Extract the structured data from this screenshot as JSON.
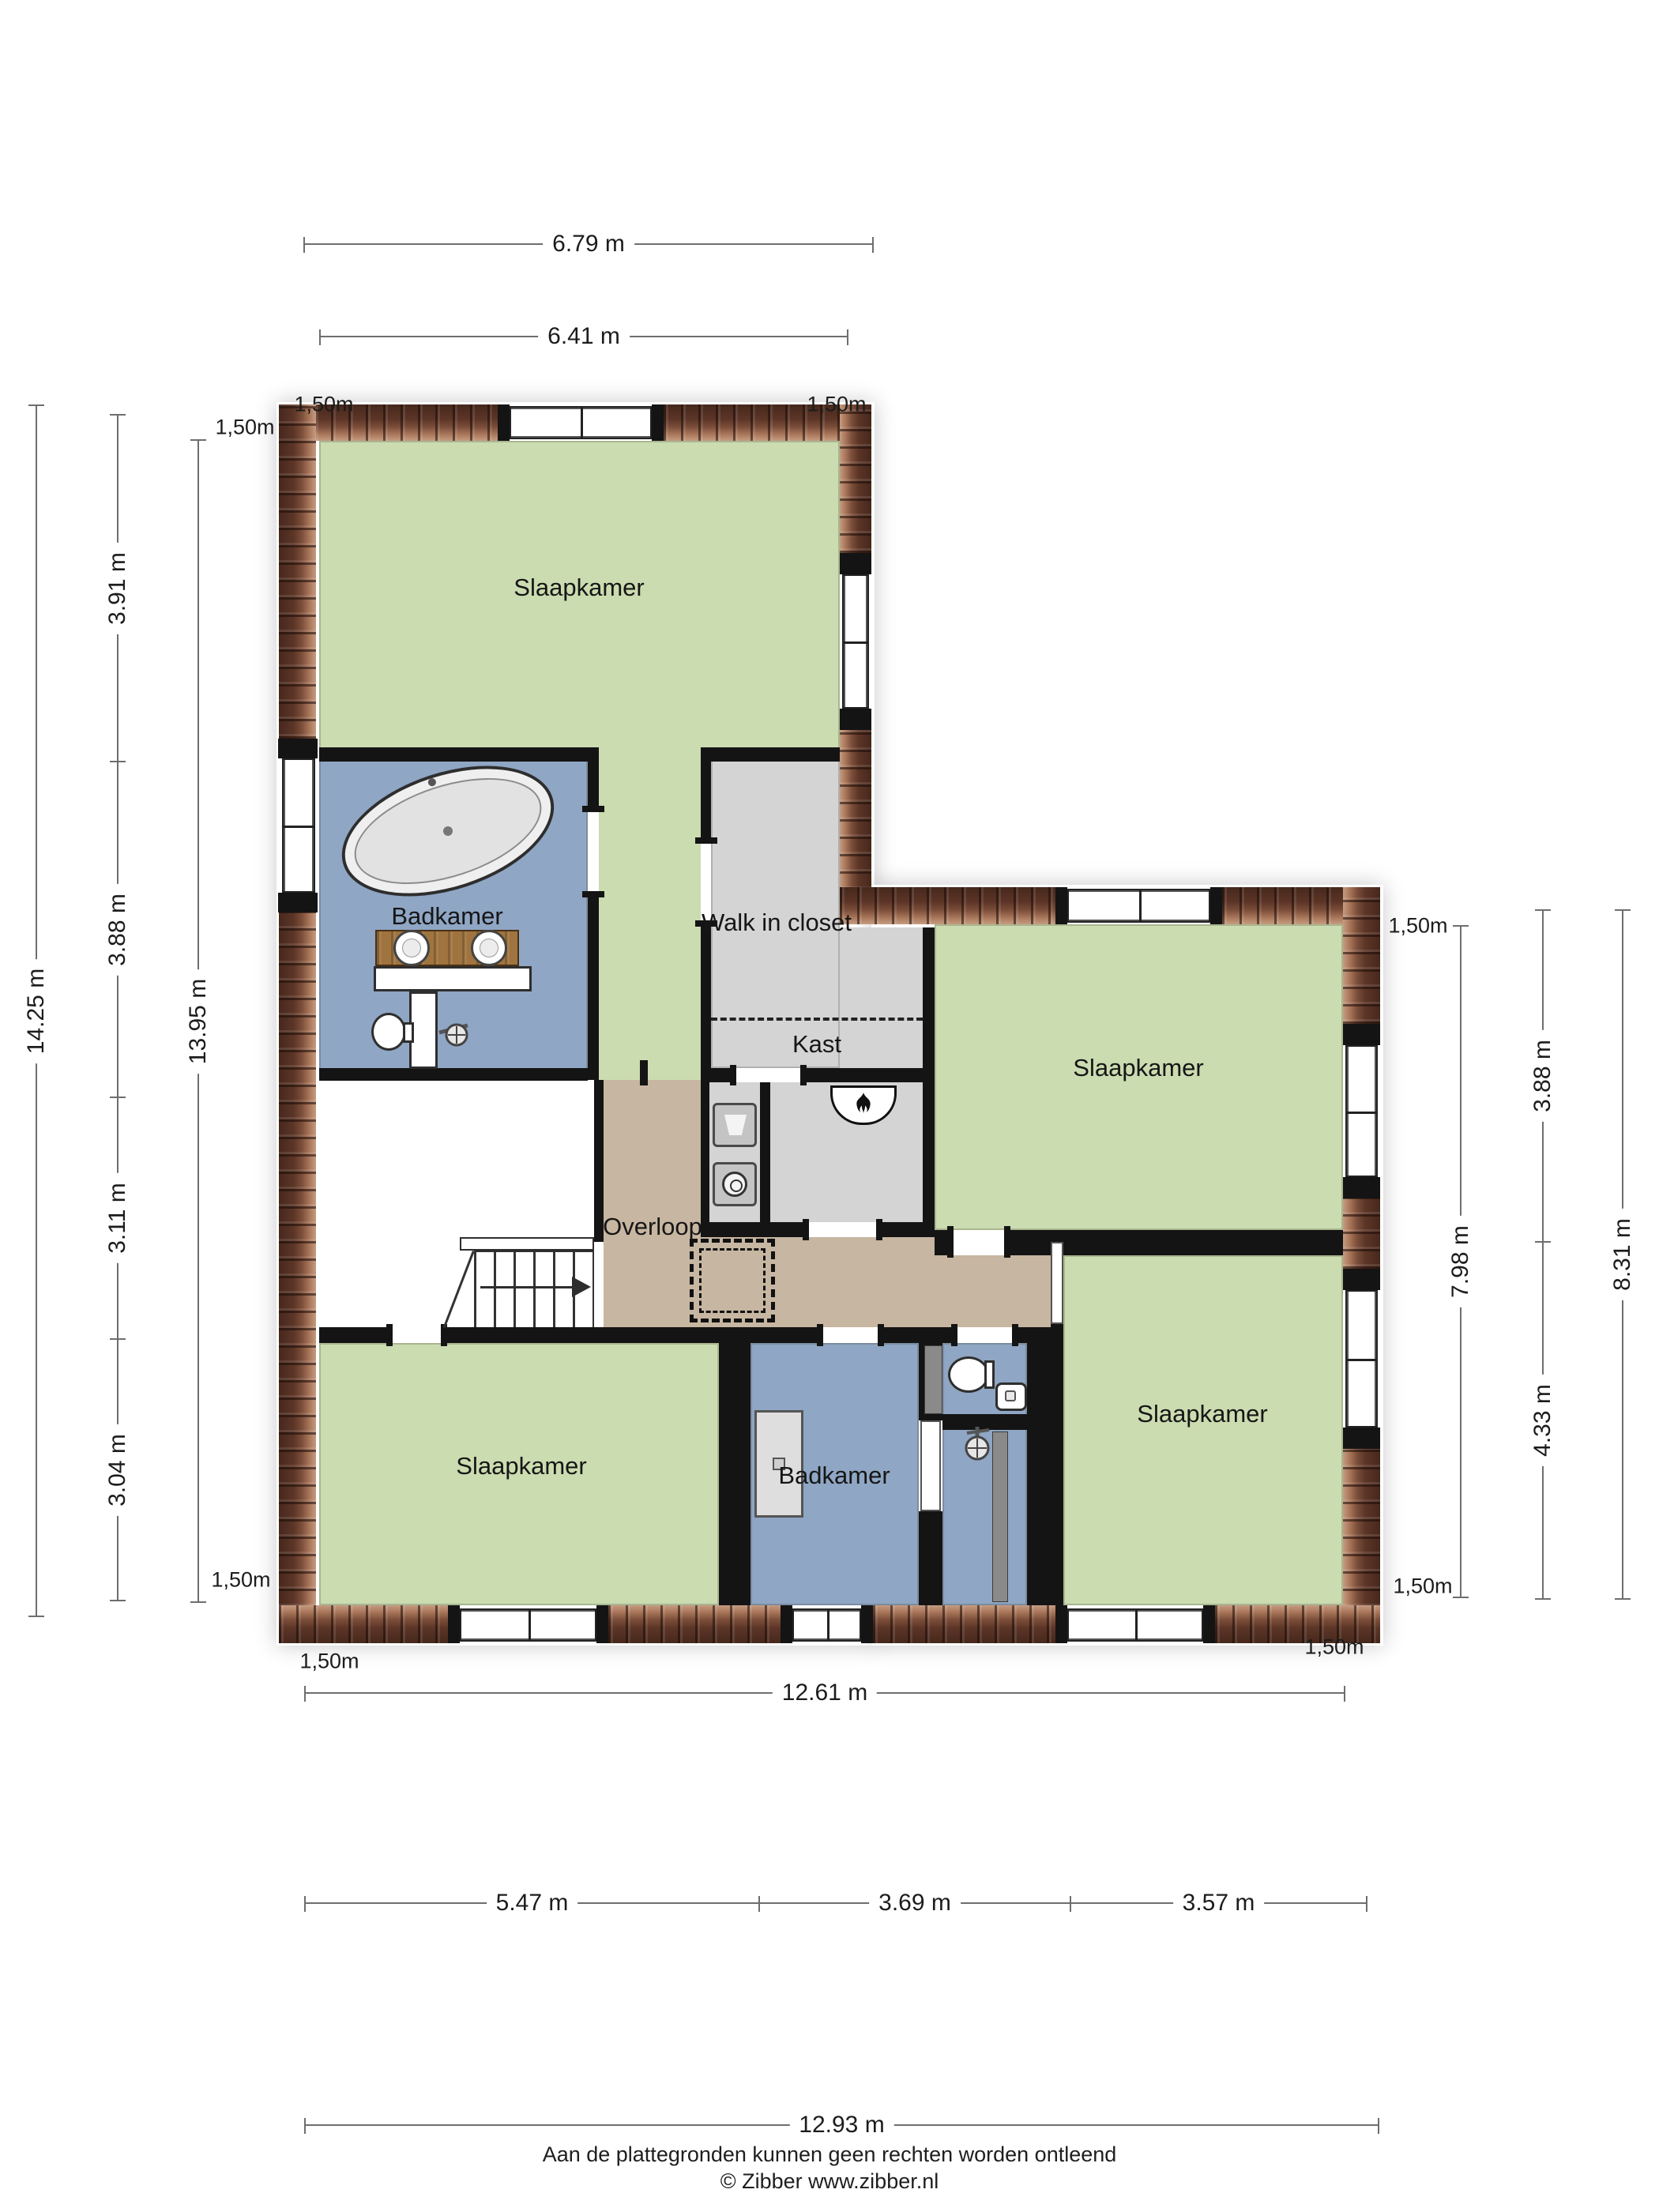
{
  "rooms": {
    "bedroom_tl": "Slaapkamer",
    "bathroom_tl": "Badkamer",
    "walk_in_closet": "Walk in closet",
    "closet": "Kast",
    "bedroom_r": "Slaapkamer",
    "landing": "Overloop",
    "bedroom_bl": "Slaapkamer",
    "bathroom_b": "Badkamer",
    "bedroom_br": "Slaapkamer"
  },
  "dimensions": {
    "knee": "1,50m",
    "top_total": "6.79 m",
    "top_inner": "6.41 m",
    "left_total": "14.25 m",
    "left_inner": "13.95 m",
    "left_seg_1": "3.91 m",
    "left_seg_2": "3.88 m",
    "left_seg_3": "3.11 m",
    "left_seg_4": "3.04 m",
    "right_inner": "7.98 m",
    "right_seg_1": "3.88 m",
    "right_seg_2": "4.33 m",
    "right_total": "8.31 m",
    "bottom_inner": "12.61 m",
    "bottom_seg_1": "5.47 m",
    "bottom_seg_2": "3.69 m",
    "bottom_seg_3": "3.57 m",
    "bottom_total": "12.93 m"
  },
  "footer": {
    "disclaimer": "Aan de plattegronden kunnen geen rechten worden ontleend",
    "copyright": "© Zibber www.zibber.nl"
  },
  "colors": {
    "bedroom_green": "#cbdcb0",
    "bathroom_blue": "#8fa6c4",
    "closet_grey": "#d4d4d4",
    "landing_tan": "#c7b6a1",
    "brick": "#6a4132",
    "wall": "#141414"
  }
}
